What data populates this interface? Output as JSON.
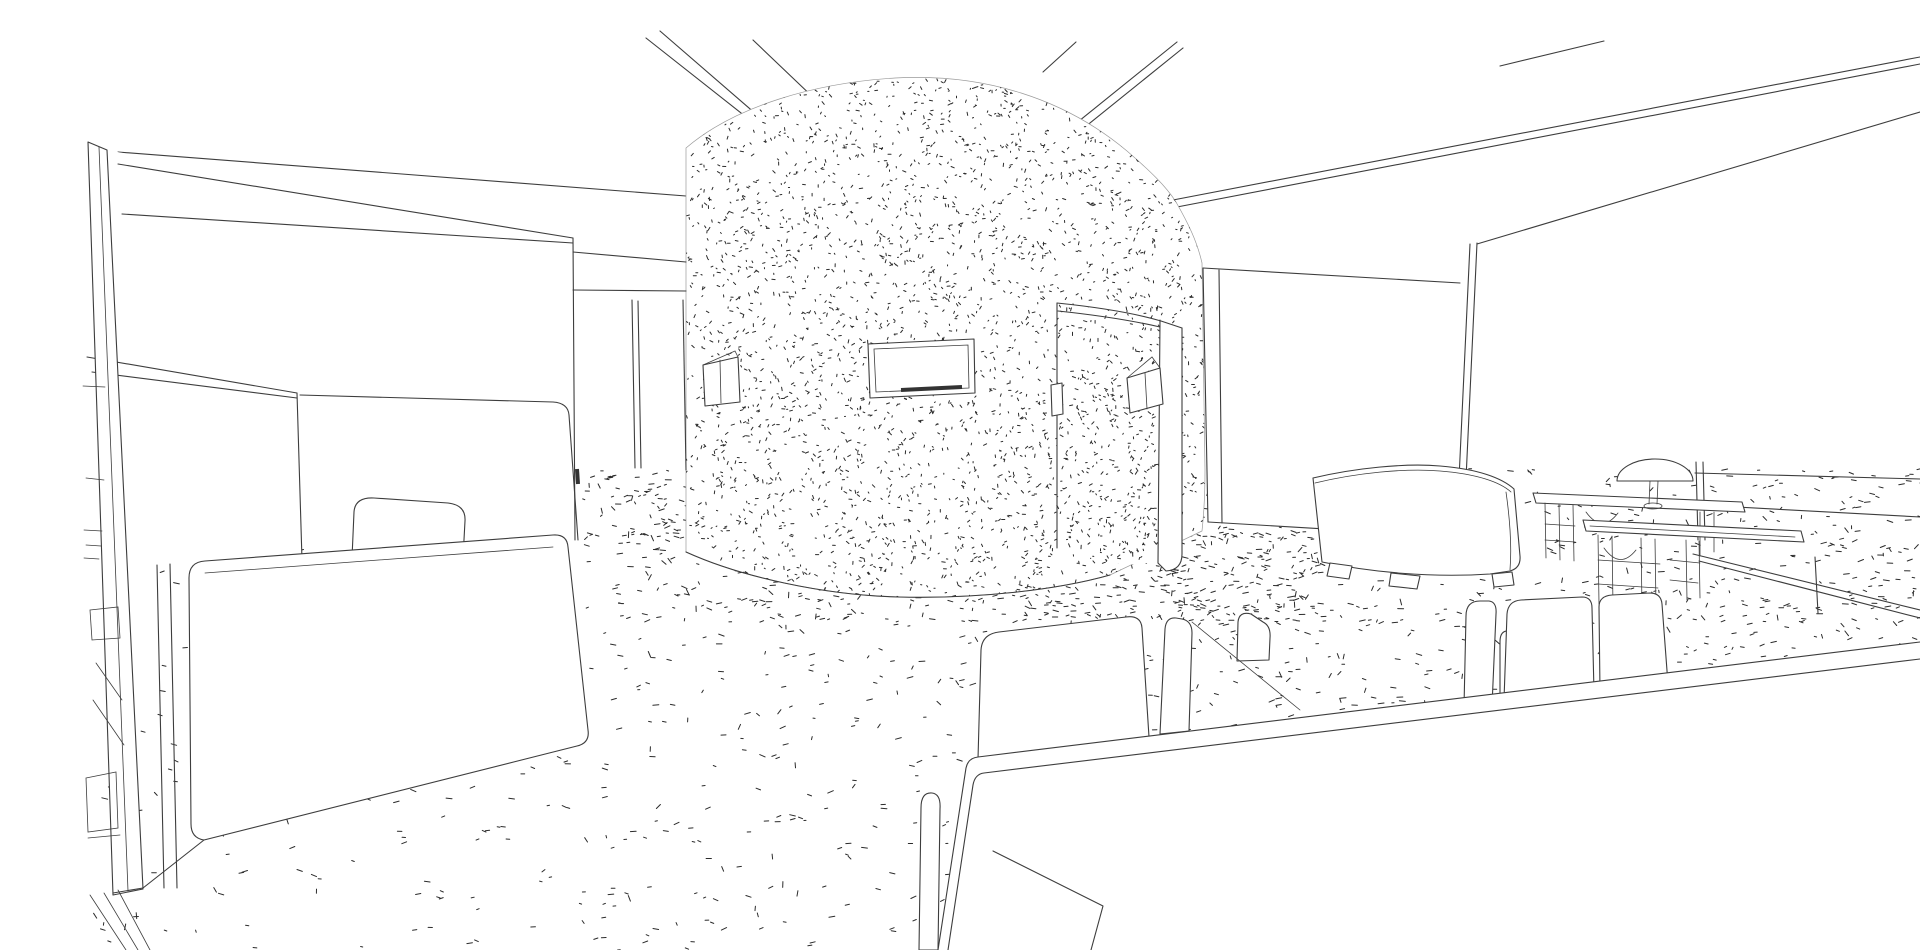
{
  "scene": {
    "label": "Architectural interior perspective, hidden-line rendering of an office lounge with curved stippled feature wall, workstation cubicle, sofa, dome lamp side tables and meeting table",
    "background_color": "#ffffff",
    "line_color": "#3d3d3d",
    "texture_color": "#2b2b2b",
    "objects": [
      {
        "name": "ceiling-edge-lines"
      },
      {
        "name": "curved-feature-wall"
      },
      {
        "name": "wall-art-frame"
      },
      {
        "name": "wall-niche"
      },
      {
        "name": "curved-screen-wall"
      },
      {
        "name": "screen-window"
      },
      {
        "name": "doorway-wall"
      },
      {
        "name": "left-partition-panel"
      },
      {
        "name": "workstation-cubicle"
      },
      {
        "name": "task-chair"
      },
      {
        "name": "sofa"
      },
      {
        "name": "slatted-side-tables"
      },
      {
        "name": "dome-table-lamp"
      },
      {
        "name": "window-bench"
      },
      {
        "name": "lounge-chairs"
      },
      {
        "name": "meeting-table"
      },
      {
        "name": "meeting-chairs"
      },
      {
        "name": "carpet-stipple-texture"
      }
    ]
  }
}
